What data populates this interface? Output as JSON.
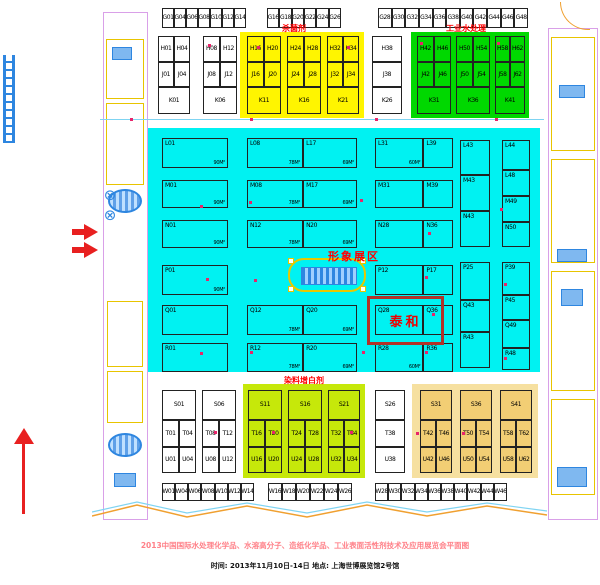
{
  "zone_titles": {
    "bactericide": "杀菌剂",
    "industrial_water": "工业水处理",
    "image_area": "形象展区",
    "dye_brightener": "染料增白剂",
    "taihe": "泰和"
  },
  "footer": {
    "line1": "2013中国国际水处理化学品、水溶高分子、造纸化学品、工业表面活性剂技术及应用展览会平面图",
    "line2": "时间: 2013年11月10日-14日    地点: 上海世博展览馆2号馆"
  },
  "colors": {
    "cyan_zone": "#00F2F2",
    "yellow_zone": "#FFF500",
    "green_zone": "#00D800",
    "yellow_green_zone": "#C6E80A",
    "tan_zone": "#F6E0A0",
    "tan_cell": "#F2CE74",
    "red_text": "#FF0000",
    "taihe_border": "#B23228",
    "footer_pink": "#FF8088",
    "aisle_blue": "#7FD4F2",
    "marker_red": "#E8256A"
  },
  "zones": [
    {
      "name": "zone-bactericide",
      "x": 240,
      "y": 32,
      "w": 124,
      "h": 86,
      "color": "#FFF500"
    },
    {
      "name": "zone-industrial-water",
      "x": 411,
      "y": 32,
      "w": 118,
      "h": 86,
      "color": "#00D800"
    },
    {
      "name": "zone-main-cyan",
      "x": 148,
      "y": 128,
      "w": 392,
      "h": 244,
      "color": "#00F2F2"
    },
    {
      "name": "zone-dye-brightener",
      "x": 243,
      "y": 384,
      "w": 122,
      "h": 94,
      "color": "#C6E80A"
    },
    {
      "name": "zone-surfactant-tan",
      "x": 412,
      "y": 384,
      "w": 126,
      "h": 94,
      "color": "#F6E0A0"
    }
  ],
  "blocks": [
    {
      "x": 162,
      "y": 8,
      "w": 84,
      "bg": "#fff",
      "rows": [
        {
          "h": 20,
          "cells": [
            "G01",
            "G04",
            "G06",
            "G08",
            "G10",
            "G12",
            "G14"
          ]
        }
      ]
    },
    {
      "x": 267,
      "y": 8,
      "w": 74,
      "bg": "#fff",
      "rows": [
        {
          "h": 20,
          "cells": [
            "G16",
            "G18",
            "G20",
            "G22",
            "G24",
            "G26"
          ]
        }
      ]
    },
    {
      "x": 378,
      "y": 8,
      "w": 150,
      "bg": "#fff",
      "rows": [
        {
          "h": 20,
          "cells": [
            "G28",
            "G30",
            "G32",
            "G34",
            "G36",
            "G38",
            "G40",
            "G42",
            "G44",
            "G46",
            "G48"
          ]
        }
      ]
    },
    {
      "x": 158,
      "y": 36,
      "w": 32,
      "bg": "#fff",
      "rows": [
        {
          "h": 26,
          "cells": [
            "H01",
            "H04"
          ]
        },
        {
          "h": 25,
          "cells": [
            "J01",
            "J04"
          ]
        },
        {
          "h": 27,
          "cells": [
            "K01"
          ]
        }
      ]
    },
    {
      "x": 203,
      "y": 36,
      "w": 34,
      "bg": "#fff",
      "rows": [
        {
          "h": 26,
          "cells": [
            "H08",
            "H12"
          ]
        },
        {
          "h": 25,
          "cells": [
            "J08",
            "J12"
          ]
        },
        {
          "h": 27,
          "cells": [
            "K06"
          ]
        }
      ]
    },
    {
      "x": 247,
      "y": 36,
      "w": 34,
      "rows": [
        {
          "h": 26,
          "cells": [
            "H16",
            "H20"
          ]
        },
        {
          "h": 25,
          "cells": [
            "J16",
            "J20"
          ]
        },
        {
          "h": 27,
          "cells": [
            "K11"
          ]
        }
      ]
    },
    {
      "x": 287,
      "y": 36,
      "w": 34,
      "rows": [
        {
          "h": 26,
          "cells": [
            "H24",
            "H28"
          ]
        },
        {
          "h": 25,
          "cells": [
            "J24",
            "J28"
          ]
        },
        {
          "h": 27,
          "cells": [
            "K16"
          ]
        }
      ]
    },
    {
      "x": 327,
      "y": 36,
      "w": 32,
      "rows": [
        {
          "h": 26,
          "cells": [
            "H32",
            "H34"
          ]
        },
        {
          "h": 25,
          "cells": [
            "J32",
            "J34"
          ]
        },
        {
          "h": 27,
          "cells": [
            "K21"
          ]
        }
      ]
    },
    {
      "x": 372,
      "y": 36,
      "w": 30,
      "bg": "#fff",
      "rows": [
        {
          "h": 26,
          "cells": [
            "H38"
          ]
        },
        {
          "h": 25,
          "cells": [
            "J38"
          ]
        },
        {
          "h": 27,
          "cells": [
            "K26"
          ]
        }
      ]
    },
    {
      "x": 417,
      "y": 36,
      "w": 34,
      "rows": [
        {
          "h": 26,
          "cells": [
            "H42",
            "H46"
          ]
        },
        {
          "h": 25,
          "cells": [
            "J42",
            "J46"
          ]
        },
        {
          "h": 27,
          "cells": [
            "K31"
          ]
        }
      ]
    },
    {
      "x": 456,
      "y": 36,
      "w": 34,
      "rows": [
        {
          "h": 26,
          "cells": [
            "H50",
            "H54"
          ]
        },
        {
          "h": 25,
          "cells": [
            "J50",
            "J54"
          ]
        },
        {
          "h": 27,
          "cells": [
            "K36"
          ]
        }
      ]
    },
    {
      "x": 495,
      "y": 36,
      "w": 30,
      "rows": [
        {
          "h": 26,
          "cells": [
            "H58",
            "H62"
          ]
        },
        {
          "h": 25,
          "cells": [
            "J58",
            "J62"
          ]
        },
        {
          "h": 27,
          "cells": [
            "K41"
          ]
        }
      ]
    },
    {
      "x": 162,
      "y": 138,
      "w": 66,
      "lab": "tl",
      "rows": [
        {
          "h": 30,
          "cells": [
            {
              "t": "L01",
              "a": "90M²"
            }
          ]
        },
        {
          "dy": 12,
          "h": 28,
          "cells": [
            {
              "t": "M01",
              "a": "90M²"
            }
          ]
        },
        {
          "dy": 12,
          "h": 28,
          "cells": [
            {
              "t": "N01",
              "a": "90M²"
            }
          ]
        },
        {
          "dy": 17,
          "h": 30,
          "cells": [
            {
              "t": "P01",
              "a": "90M²"
            }
          ]
        },
        {
          "dy": 10,
          "h": 30,
          "cells": [
            "Q01"
          ]
        },
        {
          "dy": 8,
          "h": 29,
          "cells": [
            "R01"
          ]
        }
      ]
    },
    {
      "x": 247,
      "y": 138,
      "w": 110,
      "lab": "tl",
      "ws": [
        0.51,
        0.49
      ],
      "rows": [
        {
          "h": 30,
          "cells": [
            {
              "t": "L08",
              "a": "78M²"
            },
            {
              "t": "L17",
              "a": "69M²"
            }
          ]
        },
        {
          "dy": 12,
          "h": 28,
          "cells": [
            {
              "t": "M08",
              "a": "78M²"
            },
            {
              "t": "M17",
              "a": "69M²"
            }
          ]
        },
        {
          "dy": 12,
          "h": 28,
          "cells": [
            {
              "t": "N12",
              "a": "78M²"
            },
            {
              "t": "N20",
              "a": "69M²"
            }
          ]
        },
        {
          "dy": 57,
          "h": 30,
          "cells": [
            {
              "t": "Q12",
              "a": "78M²"
            },
            {
              "t": "Q20",
              "a": "69M²"
            }
          ]
        },
        {
          "dy": 8,
          "h": 29,
          "cells": [
            {
              "t": "R12",
              "a": "78M²"
            },
            {
              "t": "R20",
              "a": "69M²"
            }
          ]
        }
      ]
    },
    {
      "x": 375,
      "y": 138,
      "w": 78,
      "lab": "tl",
      "ws": [
        0.62,
        0.38
      ],
      "rows": [
        {
          "h": 30,
          "cells": [
            {
              "t": "L31",
              "a": "60M²"
            },
            "L39"
          ]
        },
        {
          "dy": 12,
          "h": 28,
          "cells": [
            "M31",
            "M39"
          ]
        },
        {
          "dy": 12,
          "h": 28,
          "cells": [
            "N28",
            "N36"
          ]
        },
        {
          "dy": 17,
          "h": 30,
          "cells": [
            "P12",
            "P17"
          ]
        },
        {
          "dy": 10,
          "h": 30,
          "cells": [
            "Q28",
            "Q36"
          ]
        },
        {
          "dy": 8,
          "h": 29,
          "cells": [
            {
              "t": "R28",
              "a": "60M²"
            },
            "R36"
          ]
        }
      ]
    },
    {
      "x": 460,
      "y": 140,
      "w": 30,
      "lab": "tl",
      "rows": [
        {
          "h": 35,
          "cells": [
            "L43"
          ]
        },
        {
          "h": 36,
          "cells": [
            "M43"
          ]
        },
        {
          "h": 36,
          "cells": [
            "N43"
          ]
        },
        {
          "dy": 15,
          "h": 38,
          "cells": [
            "P25"
          ]
        },
        {
          "h": 32,
          "cells": [
            "Q43"
          ]
        },
        {
          "h": 36,
          "cells": [
            "R43"
          ]
        }
      ]
    },
    {
      "x": 502,
      "y": 140,
      "w": 28,
      "lab": "tl",
      "rows": [
        {
          "h": 30,
          "cells": [
            "L44"
          ]
        },
        {
          "h": 26,
          "cells": [
            "L48"
          ]
        },
        {
          "h": 26,
          "cells": [
            "M49"
          ]
        },
        {
          "h": 25,
          "cells": [
            "N50"
          ]
        },
        {
          "dy": 15,
          "h": 33,
          "cells": [
            "P39"
          ]
        },
        {
          "h": 25,
          "cells": [
            "P45"
          ]
        },
        {
          "h": 28,
          "cells": [
            "Q49"
          ]
        },
        {
          "h": 22,
          "cells": [
            "R48"
          ]
        }
      ]
    },
    {
      "x": 162,
      "y": 390,
      "w": 34,
      "bg": "#fff",
      "rows": [
        {
          "h": 30,
          "cells": [
            "S01"
          ]
        },
        {
          "h": 27,
          "cells": [
            "T01",
            "T04"
          ]
        },
        {
          "h": 26,
          "cells": [
            "U01",
            "U04"
          ]
        }
      ]
    },
    {
      "x": 202,
      "y": 390,
      "w": 34,
      "bg": "#fff",
      "rows": [
        {
          "h": 30,
          "cells": [
            "S06"
          ]
        },
        {
          "h": 27,
          "cells": [
            "T08",
            "T12"
          ]
        },
        {
          "h": 26,
          "cells": [
            "U08",
            "U12"
          ]
        }
      ]
    },
    {
      "x": 248,
      "y": 390,
      "w": 34,
      "rows": [
        {
          "h": 30,
          "cells": [
            "S11"
          ]
        },
        {
          "h": 27,
          "cells": [
            "T16",
            "T20"
          ]
        },
        {
          "h": 26,
          "cells": [
            "U16",
            "U20"
          ]
        }
      ]
    },
    {
      "x": 288,
      "y": 390,
      "w": 34,
      "rows": [
        {
          "h": 30,
          "cells": [
            "S16"
          ]
        },
        {
          "h": 27,
          "cells": [
            "T24",
            "T28"
          ]
        },
        {
          "h": 26,
          "cells": [
            "U24",
            "U28"
          ]
        }
      ]
    },
    {
      "x": 328,
      "y": 390,
      "w": 32,
      "rows": [
        {
          "h": 30,
          "cells": [
            "S21"
          ]
        },
        {
          "h": 27,
          "cells": [
            "T32",
            "T34"
          ]
        },
        {
          "h": 26,
          "cells": [
            "U32",
            "U34"
          ]
        }
      ]
    },
    {
      "x": 375,
      "y": 390,
      "w": 30,
      "bg": "#fff",
      "rows": [
        {
          "h": 30,
          "cells": [
            "S26"
          ]
        },
        {
          "h": 27,
          "cells": [
            "T38"
          ]
        },
        {
          "h": 26,
          "cells": [
            "U38"
          ]
        }
      ]
    },
    {
      "x": 420,
      "y": 390,
      "w": 32,
      "bg": "#F2CE74",
      "rows": [
        {
          "h": 30,
          "cells": [
            "S31"
          ]
        },
        {
          "h": 27,
          "cells": [
            "T42",
            "T46"
          ]
        },
        {
          "h": 26,
          "cells": [
            "U42",
            "U46"
          ]
        }
      ]
    },
    {
      "x": 460,
      "y": 390,
      "w": 32,
      "bg": "#F2CE74",
      "rows": [
        {
          "h": 30,
          "cells": [
            "S36"
          ]
        },
        {
          "h": 27,
          "cells": [
            "T50",
            "T54"
          ]
        },
        {
          "h": 26,
          "cells": [
            "U50",
            "U54"
          ]
        }
      ]
    },
    {
      "x": 500,
      "y": 390,
      "w": 32,
      "bg": "#F2CE74",
      "rows": [
        {
          "h": 30,
          "cells": [
            "S41"
          ]
        },
        {
          "h": 27,
          "cells": [
            "T58",
            "T62"
          ]
        },
        {
          "h": 26,
          "cells": [
            "U58",
            "U62"
          ]
        }
      ]
    },
    {
      "x": 162,
      "y": 483,
      "w": 92,
      "bg": "#fff",
      "rows": [
        {
          "h": 18,
          "cells": [
            "W01",
            "W04",
            "W06",
            "W08",
            "W10",
            "W12",
            "W14"
          ]
        }
      ]
    },
    {
      "x": 268,
      "y": 483,
      "w": 84,
      "bg": "#fff",
      "rows": [
        {
          "h": 18,
          "cells": [
            "W16",
            "W18",
            "W20",
            "W22",
            "W24",
            "W26"
          ]
        }
      ]
    },
    {
      "x": 375,
      "y": 483,
      "w": 132,
      "bg": "#fff",
      "rows": [
        {
          "h": 18,
          "cells": [
            "W28",
            "W30",
            "W32",
            "W34",
            "W36",
            "W38",
            "W40",
            "W42",
            "W44",
            "W46"
          ]
        }
      ]
    }
  ]
}
